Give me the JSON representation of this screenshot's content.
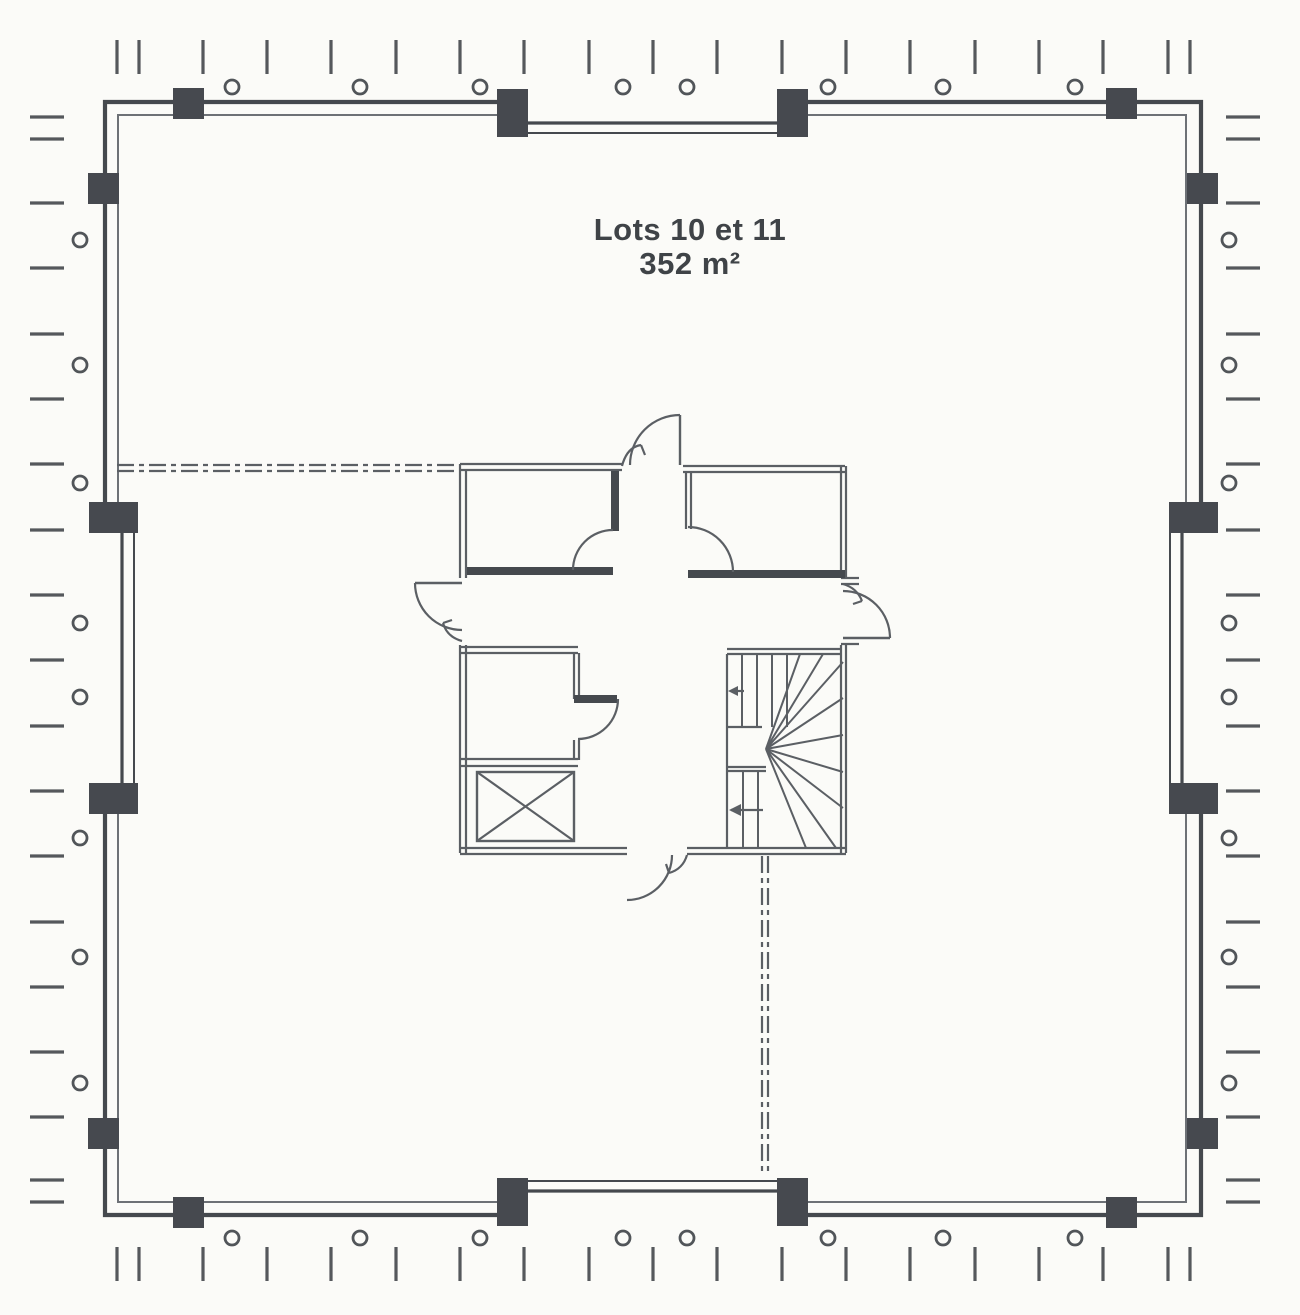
{
  "labels": {
    "lot_title": "Lots 10 et 11",
    "lot_area": "352 m²"
  },
  "colors": {
    "background": "#fbfbf8",
    "wall_dark": "#45494e",
    "wall_mid": "#5b5f64",
    "wall_light": "#6d7176",
    "column": "#46494f",
    "tick": "#55585c",
    "circle": "#515559",
    "text": "#3f4347"
  },
  "plan": {
    "canvas": {
      "width": 1300,
      "height": 1315
    },
    "outer_wall_path": "M 516 102 L 105 102 L 105 520 M 105 796 L 105 1215 L 516 1215 M 786 1215 L 1201 1215 L 1201 796 M 1201 520 L 1201 102 L 786 102",
    "inner_wall_path": "M 514 115 L 118 115 L 118 520 M 118 796 L 118 1202 L 514 1202 M 788 1202 L 1186 1202 L 1186 796 M 1186 520 L 1186 115 L 788 115",
    "recess_walls": [
      [
        516,
        123,
        786,
        123,
        3.2
      ],
      [
        516,
        133,
        786,
        133,
        2
      ],
      [
        516,
        1191,
        786,
        1191,
        3.2
      ],
      [
        516,
        1181,
        786,
        1181,
        2
      ],
      [
        122,
        520,
        122,
        796,
        3.2
      ],
      [
        134,
        520,
        134,
        796,
        2
      ],
      [
        1182,
        520,
        1182,
        796,
        3.2
      ],
      [
        1170,
        520,
        1170,
        796,
        2
      ]
    ],
    "columns": [
      [
        173,
        88,
        31,
        31
      ],
      [
        497,
        89,
        31,
        48
      ],
      [
        777,
        89,
        31,
        48
      ],
      [
        1106,
        88,
        31,
        31
      ],
      [
        173,
        1197,
        31,
        31
      ],
      [
        497,
        1178,
        31,
        48
      ],
      [
        777,
        1178,
        31,
        48
      ],
      [
        1106,
        1197,
        31,
        31
      ],
      [
        88,
        173,
        31,
        31
      ],
      [
        89,
        502,
        49,
        31
      ],
      [
        89,
        783,
        49,
        31
      ],
      [
        88,
        1118,
        31,
        31
      ],
      [
        1187,
        173,
        31,
        31
      ],
      [
        1169,
        502,
        49,
        31
      ],
      [
        1169,
        783,
        49,
        31
      ],
      [
        1187,
        1118,
        31,
        31
      ]
    ],
    "circles": {
      "radius": 7,
      "top": {
        "cy": 87,
        "cx": [
          232,
          360,
          480,
          623,
          687,
          828,
          943,
          1075
        ]
      },
      "bottom": {
        "cy": 1238,
        "cx": [
          232,
          360,
          480,
          623,
          687,
          828,
          943,
          1075
        ]
      },
      "left": {
        "cx": 80,
        "cy": [
          240,
          365,
          483,
          623,
          697,
          838,
          957,
          1083
        ]
      },
      "right": {
        "cx": 1229,
        "cy": [
          240,
          365,
          483,
          623,
          697,
          838,
          957,
          1083
        ]
      }
    },
    "ticks": {
      "x_positions": [
        117,
        139,
        203,
        267,
        331,
        396,
        460,
        524,
        589,
        653,
        717,
        782,
        846,
        910,
        975,
        1039,
        1103,
        1168,
        1190
      ],
      "y_positions": [
        117,
        139,
        203,
        268,
        334,
        399,
        464,
        530,
        595,
        660,
        726,
        791,
        856,
        922,
        987,
        1052,
        1117,
        1180,
        1202
      ],
      "top": [
        40,
        74
      ],
      "bottom": [
        1247,
        1281
      ],
      "left": [
        30,
        64
      ],
      "right": [
        1226,
        1260
      ]
    },
    "boundary_dash": "17 5 5 5",
    "boundary_lines": [
      [
        117,
        465,
        458,
        465
      ],
      [
        117,
        471,
        458,
        471
      ],
      [
        762,
        856,
        762,
        1176
      ],
      [
        768,
        856,
        768,
        1176
      ]
    ],
    "core": {
      "thin_walls": [
        [
          460,
          464,
          622,
          464
        ],
        [
          460,
          470,
          622,
          470
        ],
        [
          460,
          464,
          460,
          578
        ],
        [
          466,
          470,
          466,
          578
        ],
        [
          683,
          466,
          845,
          466
        ],
        [
          683,
          472,
          845,
          472
        ],
        [
          686,
          472,
          686,
          529
        ],
        [
          691,
          472,
          691,
          529
        ],
        [
          841,
          466,
          841,
          577
        ],
        [
          846,
          466,
          846,
          577
        ],
        [
          841,
          578,
          859,
          578
        ],
        [
          841,
          584,
          859,
          584
        ],
        [
          841,
          644,
          859,
          644
        ],
        [
          841,
          645,
          841,
          853
        ],
        [
          846,
          645,
          846,
          853
        ],
        [
          460,
          645,
          460,
          853
        ],
        [
          466,
          645,
          466,
          853
        ],
        [
          460,
          647,
          578,
          647
        ],
        [
          460,
          653,
          578,
          653
        ],
        [
          574,
          653,
          574,
          699
        ],
        [
          579,
          653,
          579,
          699
        ],
        [
          574,
          740,
          574,
          760
        ],
        [
          579,
          740,
          579,
          760
        ],
        [
          460,
          759,
          578,
          759
        ],
        [
          460,
          766,
          578,
          766
        ],
        [
          460,
          848,
          627,
          848
        ],
        [
          460,
          854,
          627,
          854
        ],
        [
          687,
          848,
          846,
          848
        ],
        [
          687,
          854,
          846,
          854
        ],
        [
          727,
          649,
          841,
          649
        ],
        [
          727,
          654,
          841,
          654
        ],
        [
          727,
          654,
          727,
          848
        ],
        [
          727,
          727,
          762,
          727
        ],
        [
          727,
          767,
          766,
          767
        ],
        [
          727,
          771,
          766,
          771
        ]
      ],
      "thick_walls": [
        [
          467,
          571,
          613,
          571
        ],
        [
          615,
          471,
          615,
          531
        ],
        [
          688,
          574,
          845,
          574
        ],
        [
          574,
          699,
          617,
          699
        ]
      ],
      "door_leaves": [
        [
          680,
          415,
          680,
          465
        ],
        [
          415,
          583,
          462,
          583
        ],
        [
          843,
          638,
          890,
          638
        ]
      ],
      "door_arcs": [
        "M 680 415 A 50 50 0 0 0 630 465",
        "M 415 583 A 47 47 0 0 0 462 630",
        "M 890 638 A 47 47 0 0 0 843 591",
        "M 672 855 A 45 45 0 0 1 627 900",
        "M 573 570 A 40 40 0 0 1 613 530",
        "M 733 572 A 45 45 0 0 0 688 527",
        "M 618 699 A 40 40 0 0 1 578 739"
      ],
      "small_leaves": [
        "M 641 445 Q 627 447 622 466 M 641 445 L 645 455",
        "M 443 623 Q 447 637 462 641 M 443 623 L 452 620",
        "M 862 601 Q 857 588 843 584 M 862 601 L 853 604",
        "M 669 873 Q 683 869 687 855 M 669 873 L 666 864"
      ],
      "stair": {
        "risers": [
          [
            742,
            654,
            727
          ],
          [
            757,
            654,
            727
          ],
          [
            772,
            654,
            727
          ],
          [
            787,
            654,
            727
          ],
          [
            743,
            771,
            848
          ],
          [
            758,
            771,
            848
          ]
        ],
        "fan_center": [
          766,
          749
        ],
        "fan_ends": [
          [
            800,
            654
          ],
          [
            823,
            654
          ],
          [
            843,
            662
          ],
          [
            843,
            698
          ],
          [
            843,
            735
          ],
          [
            843,
            772
          ],
          [
            843,
            808
          ],
          [
            836,
            848
          ],
          [
            806,
            848
          ]
        ],
        "arrows": [
          {
            "line": [
              763,
              810,
              731,
              810
            ],
            "head": [
              [
                729,
                810
              ],
              [
                741,
                804
              ],
              [
                741,
                816
              ]
            ]
          },
          {
            "line": [
              744,
              691,
              731,
              691
            ],
            "head": [
              [
                728,
                691
              ],
              [
                738,
                686
              ],
              [
                738,
                696
              ]
            ]
          }
        ]
      },
      "elevator": {
        "rect": [
          477,
          772,
          97,
          69
        ]
      }
    },
    "title_pos": {
      "x": 690,
      "y1": 240,
      "y2": 274
    }
  }
}
